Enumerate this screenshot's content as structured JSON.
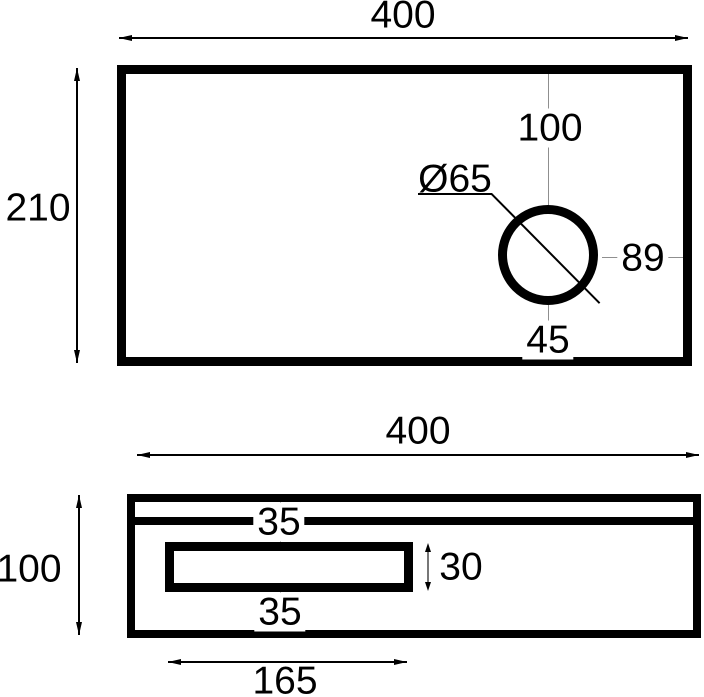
{
  "drawing": {
    "type": "engineering-orthographic-views",
    "colors": {
      "outline": "#000000",
      "centerline": "#8f8f8f",
      "background": "#ffffff"
    },
    "top_view": {
      "width": "400",
      "height": "210",
      "hole_offset_top": "100",
      "hole_diameter": "Ø65",
      "hole_offset_right": "89",
      "hole_offset_bottom": "45"
    },
    "bottom_view": {
      "width": "400",
      "height": "100",
      "inset_top": "35",
      "inset_bottom": "35",
      "slot_height": "30",
      "slot_width": "165"
    }
  }
}
